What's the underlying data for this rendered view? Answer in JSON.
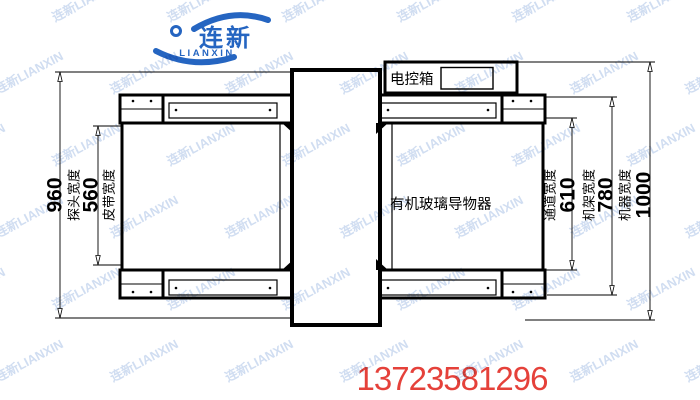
{
  "colors": {
    "background": "#ffffff",
    "line": "#000000",
    "brand": "#2565c1",
    "watermark": "rgba(118,156,214,0.34)",
    "phone": "#e5413a"
  },
  "logo": {
    "cn": "连新",
    "en": "LIANXIN"
  },
  "watermark": {
    "text": "连新LIANXIN"
  },
  "drawing": {
    "control_box_label": "电控箱",
    "guide_label": "有机玻璃导物器",
    "dimensions": [
      {
        "value": "960",
        "label": "探头宽度"
      },
      {
        "value": "560",
        "label": "皮带宽度"
      },
      {
        "value": "610",
        "label": "通道宽度"
      },
      {
        "value": "780",
        "label": "机架宽度"
      },
      {
        "value": "1000",
        "label": "机器宽度"
      }
    ]
  },
  "footer": {
    "phone": "13723581296"
  }
}
